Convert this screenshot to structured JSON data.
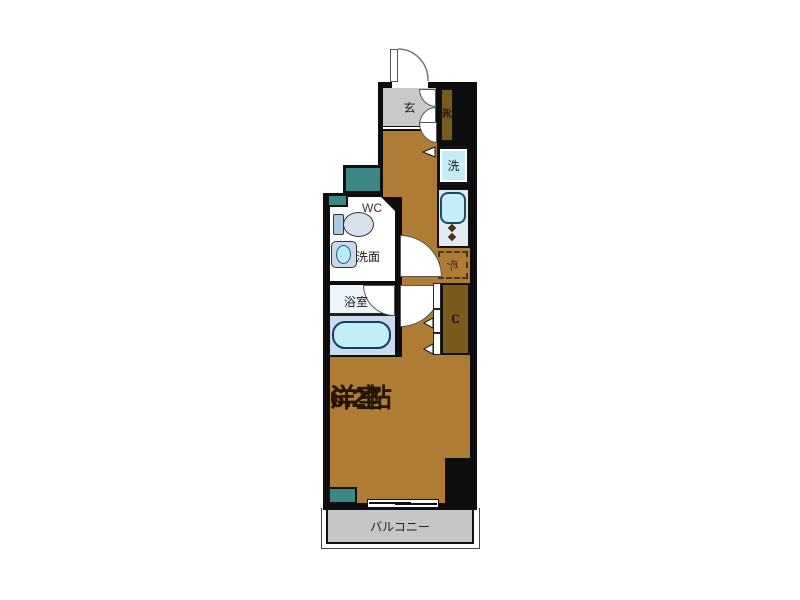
{
  "floorplan": {
    "title": "1K apartment floor plan",
    "labels": {
      "entrance": "玄",
      "shoe_box_chars": [
        "靴",
        "入"
      ],
      "washing_machine": "洗",
      "toilet": "WC",
      "washbasin": "洗面",
      "bathroom": "浴室",
      "refrigerator": "冷",
      "closet_chars": [
        "C",
        "L"
      ],
      "main_room_name": "洋室",
      "main_room_size": "6.2帖",
      "balcony": "バルコニー"
    },
    "colors": {
      "wall": "#0d0d0d",
      "floor_brown": "#ae7c35",
      "storage_brown": "#7b5a1e",
      "entrance_gray": "#c9c9c9",
      "balcony_gray": "#c6c6c6",
      "pipe_space_teal": "#3e8787",
      "fixture_cyan": "#c4edf5",
      "counter_blue": "#e0eaf3"
    }
  }
}
